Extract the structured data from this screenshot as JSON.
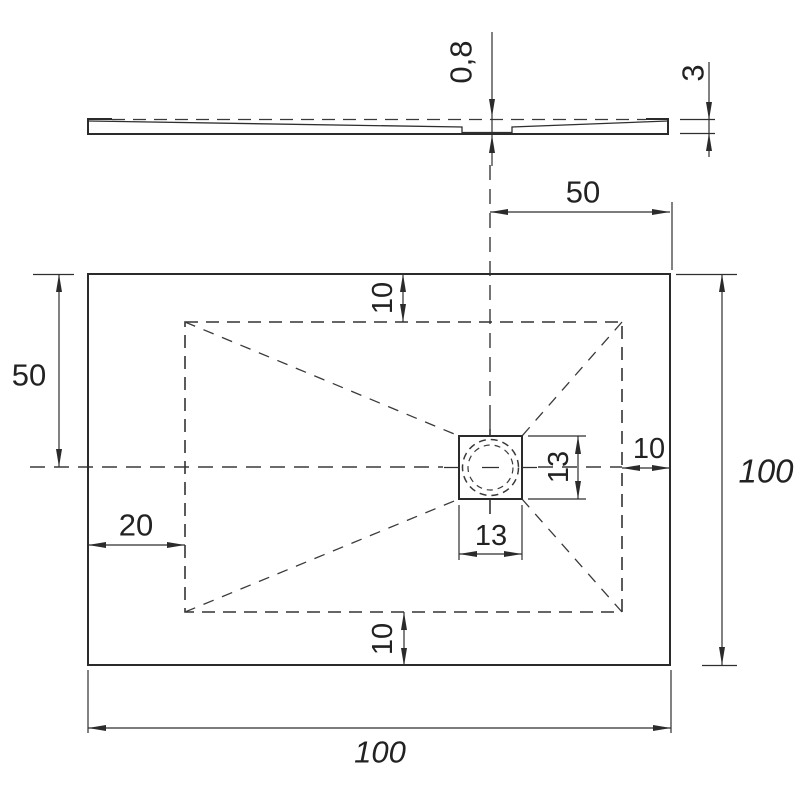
{
  "side_view": {
    "recess_depth": "0,8",
    "edge_thickness": "3"
  },
  "plan_view": {
    "drain_offset_from_right": "50",
    "half_height_left": "50",
    "inner_margin_top": "10",
    "inner_margin_bottom": "10",
    "inner_margin_right": "10",
    "left_edge_to_inner": "20",
    "drain_width": "13",
    "drain_height": "13",
    "total_width": "100",
    "total_height": "100"
  },
  "colors": {
    "line": "#2b2b2b",
    "background": "#ffffff"
  }
}
